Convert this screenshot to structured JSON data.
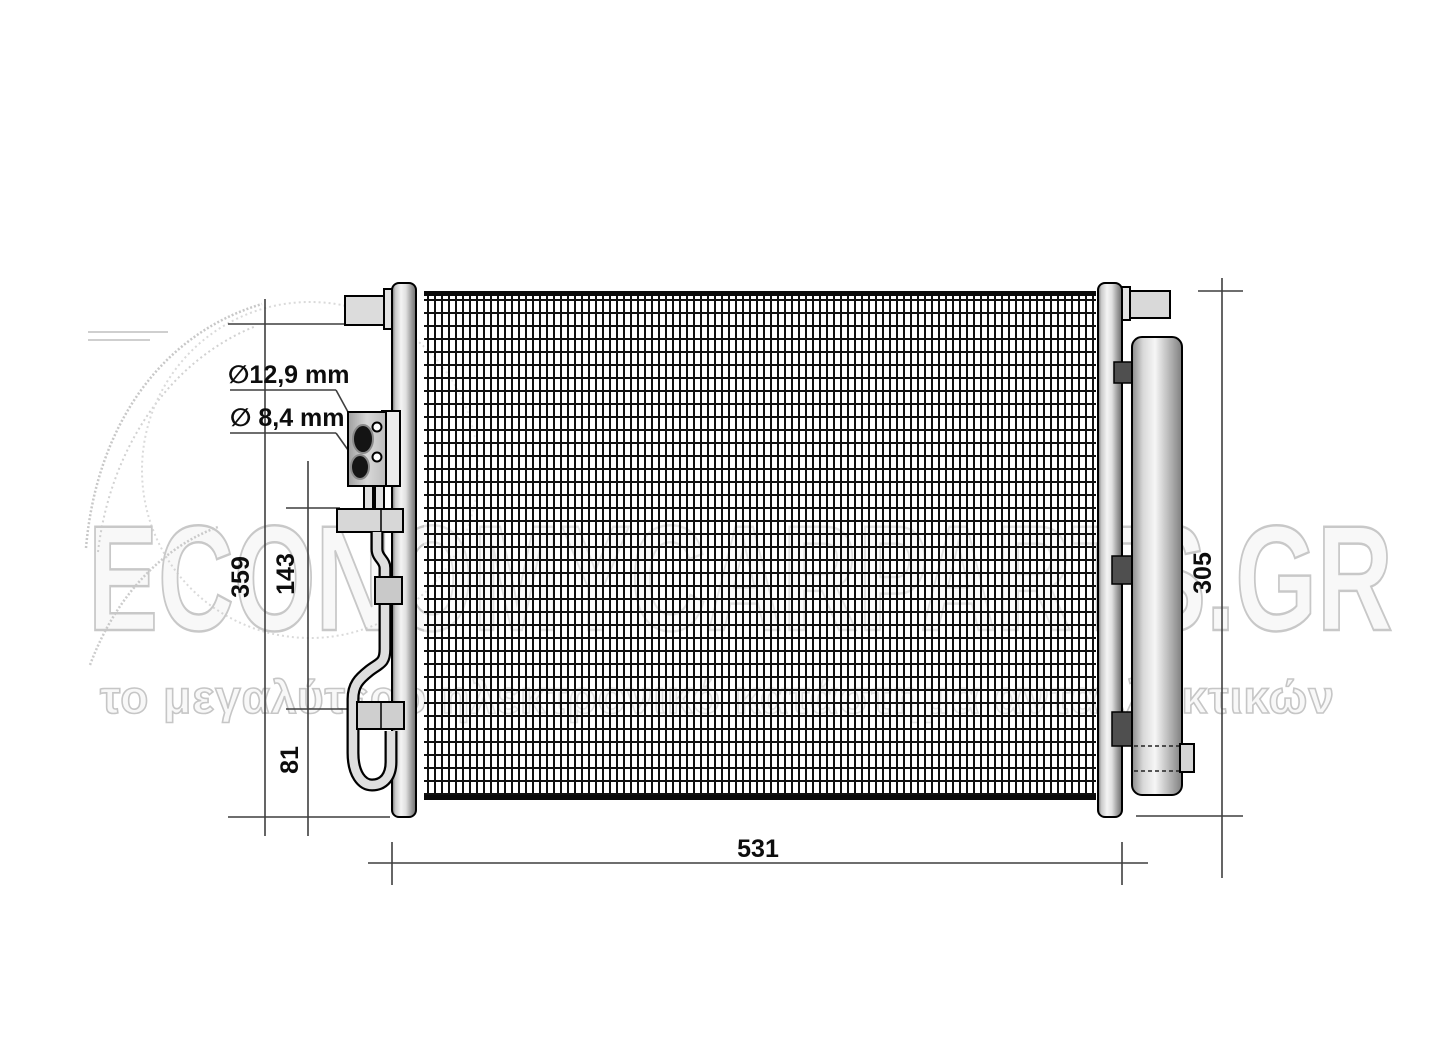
{
  "watermark": {
    "brand": "ECONOMYCARPARTS.GR",
    "tagline": "το μεγαλύτερο ηλεκτρονικό κατάστημα ανταλλακτικών"
  },
  "labels": {
    "port_diameter_large": "∅12,9 mm",
    "port_diameter_small": "∅ 8,4 mm",
    "overall_height": "359",
    "bracket_distance": "143",
    "lower_offset": "81",
    "core_width": "531",
    "drier_length": "305"
  },
  "colors": {
    "outline": "#000000",
    "dimension_line": "#3f3f3f",
    "metal_light": "#f2f2f2",
    "metal_dark": "#6e6e6e",
    "clamp_dark": "#4f4f4f",
    "watermark_gray": "#c8c8c8"
  }
}
